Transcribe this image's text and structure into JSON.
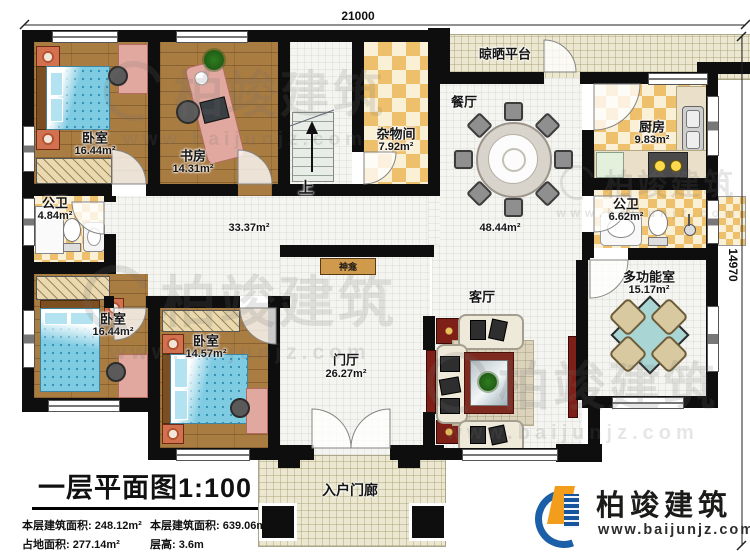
{
  "plan": {
    "dimensions": {
      "top_width": "21000",
      "right_height": "14970"
    },
    "rooms": [
      {
        "name": "卧室",
        "area": "16.44m²"
      },
      {
        "name": "书房",
        "area": "14.31m²"
      },
      {
        "name": "杂物间",
        "area": "7.92m²"
      },
      {
        "name": "晾晒平台"
      },
      {
        "name": "餐厅"
      },
      {
        "name": "厨房",
        "area": "9.83m²"
      },
      {
        "name": "公卫",
        "area": "6.62m²"
      },
      {
        "name": "多功能室",
        "area": "15.17m²"
      },
      {
        "name": "公卫",
        "area": "4.84m²"
      },
      {
        "name": "卧室",
        "area": "16.44m²"
      },
      {
        "name": "卧室",
        "area": "14.57m²"
      },
      {
        "name": "门厅",
        "area": "26.27m²"
      },
      {
        "name": "客厅"
      },
      {
        "name": "入户门廊"
      }
    ],
    "open_areas": {
      "hall_area": "33.37m²",
      "dining_area": "48.44m²"
    },
    "stairs_label": "上",
    "shrine_label": "神龛"
  },
  "title_block": {
    "title": "一层平面图1:100",
    "row1_col1": "本层建筑面积: 248.12m²",
    "row1_col2": "本层建筑面积: 639.06m²",
    "row2_col1": "占地面积: 277.14m²",
    "row2_col2": "层高: 3.6m"
  },
  "brand": {
    "name": "柏竣建筑",
    "url": "www.baijunjz.com"
  },
  "watermark": {
    "name": "柏竣建筑",
    "url": "www.baijunjz.com"
  }
}
